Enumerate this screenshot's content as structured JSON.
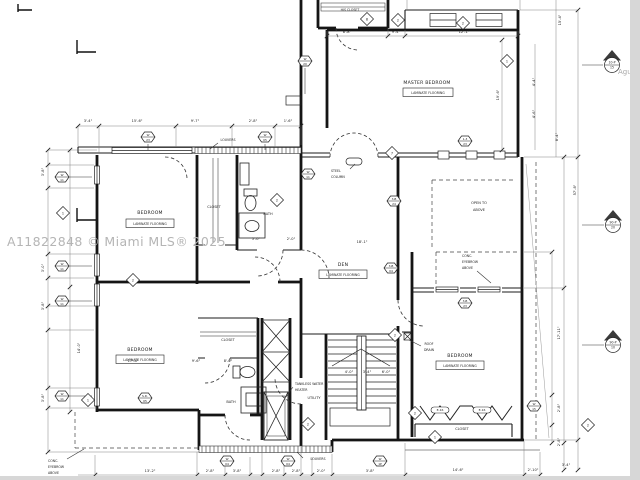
{
  "watermark": {
    "text": "A11822848 © Miami MLS® 2025",
    "partial": "Agu"
  },
  "rooms": {
    "master_bedroom": {
      "name": "MASTER BEDROOM",
      "flooring": "LAMINATE FLOORING"
    },
    "bedroom_nw": {
      "name": "BEDROOM",
      "flooring": "LAMINATE FLOORING"
    },
    "bedroom_sw": {
      "name": "BEDROOM",
      "flooring": "LAMINATE FLOORING"
    },
    "bedroom_se": {
      "name": "BEDROOM",
      "flooring": "LAMINATE FLOORING"
    },
    "den": {
      "name": "DEN",
      "flooring": "LAMINATE FLOORING"
    },
    "his_closet": "HIS CLOSET",
    "closet_nw": "CLOSET",
    "bath_nw": "BATH",
    "closet_sw": "CLOSET",
    "bath_sw": "BATH",
    "utility": "UTILITY",
    "closet_se": "CLOSET",
    "open_to_above": {
      "line1": "OPEN TO",
      "line2": "ABOVE"
    }
  },
  "notes": {
    "steel_column": {
      "line1": "STEEL",
      "line2": "COLUMN"
    },
    "louvers_top": "LOUVERS",
    "louvers_bottom": "LOUVERS",
    "roof_drain": {
      "line1": "ROOF",
      "line2": "DRAIN"
    },
    "tankless": {
      "line1": "TANKLESS WATER",
      "line2": "HEATER"
    },
    "eyebrow_left": {
      "line1": "CONC.",
      "line2": "EYEBROW",
      "line3": "ABOVE"
    },
    "eyebrow_right": {
      "line1": "CONC.",
      "line2": "EYEBROW",
      "line3": "ABOVE"
    }
  },
  "dim_labels": [
    {
      "x": 88,
      "y": 122,
      "t1": "3'-4\""
    },
    {
      "x": 137,
      "y": 122,
      "t1": "15'-6\""
    },
    {
      "x": 195,
      "y": 122,
      "t1": "9'-7\""
    },
    {
      "x": 253,
      "y": 122,
      "t1": "2'-8\""
    },
    {
      "x": 288,
      "y": 122,
      "t1": "1'-6\""
    },
    {
      "x": 347,
      "y": 33,
      "t1": "8'-8\""
    },
    {
      "x": 396,
      "y": 33,
      "t1": "9'-4\""
    },
    {
      "x": 464,
      "y": 33,
      "t1": "12'-1\""
    },
    {
      "x": 499,
      "y": 95,
      "t1": "19'-6\"",
      "rot": -90
    },
    {
      "x": 535,
      "y": 82,
      "t1": "4'-4\"",
      "rot": -90
    },
    {
      "x": 535,
      "y": 114,
      "t1": "4'-6\"",
      "rot": -90
    },
    {
      "x": 561,
      "y": 20,
      "t1": "15'-4\"",
      "rot": -90
    },
    {
      "x": 558,
      "y": 137,
      "t1": "8'-4\"",
      "rot": -90
    },
    {
      "x": 560,
      "y": 333,
      "t1": "17'-11\"",
      "rot": -90
    },
    {
      "x": 576,
      "y": 190,
      "t1": "57'-8\"",
      "rot": -90
    },
    {
      "x": 560,
      "y": 408,
      "t1": "2'-8\"",
      "rot": -90
    },
    {
      "x": 560,
      "y": 442,
      "t1": "2'-8\"",
      "rot": -90
    },
    {
      "x": 362,
      "y": 243,
      "t1": "18'-1\""
    },
    {
      "x": 133,
      "y": 362,
      "t1": "17'-8\""
    },
    {
      "x": 196,
      "y": 362,
      "t1": "9'-6\""
    },
    {
      "x": 228,
      "y": 362,
      "t1": "8'-0\""
    },
    {
      "x": 349,
      "y": 373,
      "t1": "4'-0\""
    },
    {
      "x": 367,
      "y": 373,
      "t1": "3'-4\""
    },
    {
      "x": 386,
      "y": 373,
      "t1": "6'-0\""
    },
    {
      "x": 256,
      "y": 240,
      "t1": "5'-0\""
    },
    {
      "x": 291,
      "y": 240,
      "t1": "2'-0\""
    },
    {
      "x": 80,
      "y": 348,
      "t1": "14'-0\"",
      "rot": -90
    },
    {
      "x": 44,
      "y": 172,
      "t1": "3'-8\"",
      "rot": -90
    },
    {
      "x": 44,
      "y": 268,
      "t1": "3'-0\"",
      "rot": -90
    },
    {
      "x": 44,
      "y": 306,
      "t1": "3'-8\"",
      "rot": -90
    },
    {
      "x": 44,
      "y": 398,
      "t1": "3'-8\"",
      "rot": -90
    },
    {
      "x": 150,
      "y": 472,
      "t1": "13'-2\""
    },
    {
      "x": 210,
      "y": 472,
      "t1": "2'-8\""
    },
    {
      "x": 237,
      "y": 472,
      "t1": "3'-8\""
    },
    {
      "x": 276,
      "y": 472,
      "t1": "2'-8\""
    },
    {
      "x": 296,
      "y": 472,
      "t1": "2'-8\""
    },
    {
      "x": 321,
      "y": 472,
      "t1": "2'-0\""
    },
    {
      "x": 370,
      "y": 472,
      "t1": "3'-8\""
    },
    {
      "x": 458,
      "y": 471,
      "t1": "14'-6\""
    },
    {
      "x": 533,
      "y": 471,
      "t1": "2'-10\""
    },
    {
      "x": 566,
      "y": 466,
      "t1": "3'-4\""
    }
  ],
  "window_markers": [
    {
      "x": 148,
      "y": 137,
      "t1": "W",
      "t2": "23"
    },
    {
      "x": 265,
      "y": 137,
      "t1": "W",
      "t2": "05"
    },
    {
      "x": 305,
      "y": 61,
      "t1": "W",
      "t2": "20"
    },
    {
      "x": 62,
      "y": 177,
      "t1": "W",
      "t2": "11"
    },
    {
      "x": 62,
      "y": 266,
      "t1": "W",
      "t2": "11"
    },
    {
      "x": 62,
      "y": 301,
      "t1": "W",
      "t2": "11"
    },
    {
      "x": 62,
      "y": 396,
      "t1": "W",
      "t2": "11"
    },
    {
      "x": 308,
      "y": 174,
      "t1": "W",
      "t2": "11"
    },
    {
      "x": 145,
      "y": 398,
      "t1": "S.D.",
      "t2": "05"
    },
    {
      "x": 227,
      "y": 461,
      "t1": "W",
      "t2": "04"
    },
    {
      "x": 288,
      "y": 461,
      "t1": "W",
      "t2": "04"
    },
    {
      "x": 380,
      "y": 461,
      "t1": "W",
      "t2": "1P"
    },
    {
      "x": 534,
      "y": 406,
      "t1": "W",
      "t2": "15"
    },
    {
      "x": 465,
      "y": 141,
      "t1": "1-3",
      "t2": "23"
    },
    {
      "x": 394,
      "y": 201,
      "t1": "3-B",
      "t2": "24"
    },
    {
      "x": 391,
      "y": 268,
      "t1": "3-B",
      "t2": "04"
    },
    {
      "x": 465,
      "y": 303,
      "t1": "3-B",
      "t2": "23"
    }
  ],
  "door_markers": [
    {
      "x": 398,
      "y": 20,
      "t1": "2"
    },
    {
      "x": 463,
      "y": 23,
      "t1": "2"
    },
    {
      "x": 367,
      "y": 19,
      "t1": "8"
    },
    {
      "x": 507,
      "y": 61,
      "t1": "1"
    },
    {
      "x": 392,
      "y": 153,
      "t1": "7"
    },
    {
      "x": 277,
      "y": 200,
      "t1": "2"
    },
    {
      "x": 63,
      "y": 213,
      "t1": "1"
    },
    {
      "x": 133,
      "y": 280,
      "t1": "2"
    },
    {
      "x": 88,
      "y": 400,
      "t1": "1"
    },
    {
      "x": 308,
      "y": 424,
      "t1": "2"
    },
    {
      "x": 415,
      "y": 413,
      "t1": "2"
    },
    {
      "x": 435,
      "y": 437,
      "t1": "1"
    },
    {
      "x": 395,
      "y": 335,
      "t1": "2"
    },
    {
      "x": 588,
      "y": 425,
      "t1": "2"
    }
  ],
  "closet_tags": [
    {
      "x": 440,
      "y": 410,
      "t1": "E-16"
    },
    {
      "x": 482,
      "y": 410,
      "t1": "E-16"
    }
  ],
  "elevation_markers": [
    {
      "x": 612,
      "y": 59,
      "t1": "10-P",
      "t2": "15"
    },
    {
      "x": 613,
      "y": 219,
      "t1": "90-P",
      "t2": "20"
    },
    {
      "x": 613,
      "y": 339,
      "t1": "90-P",
      "t2": "10"
    }
  ]
}
